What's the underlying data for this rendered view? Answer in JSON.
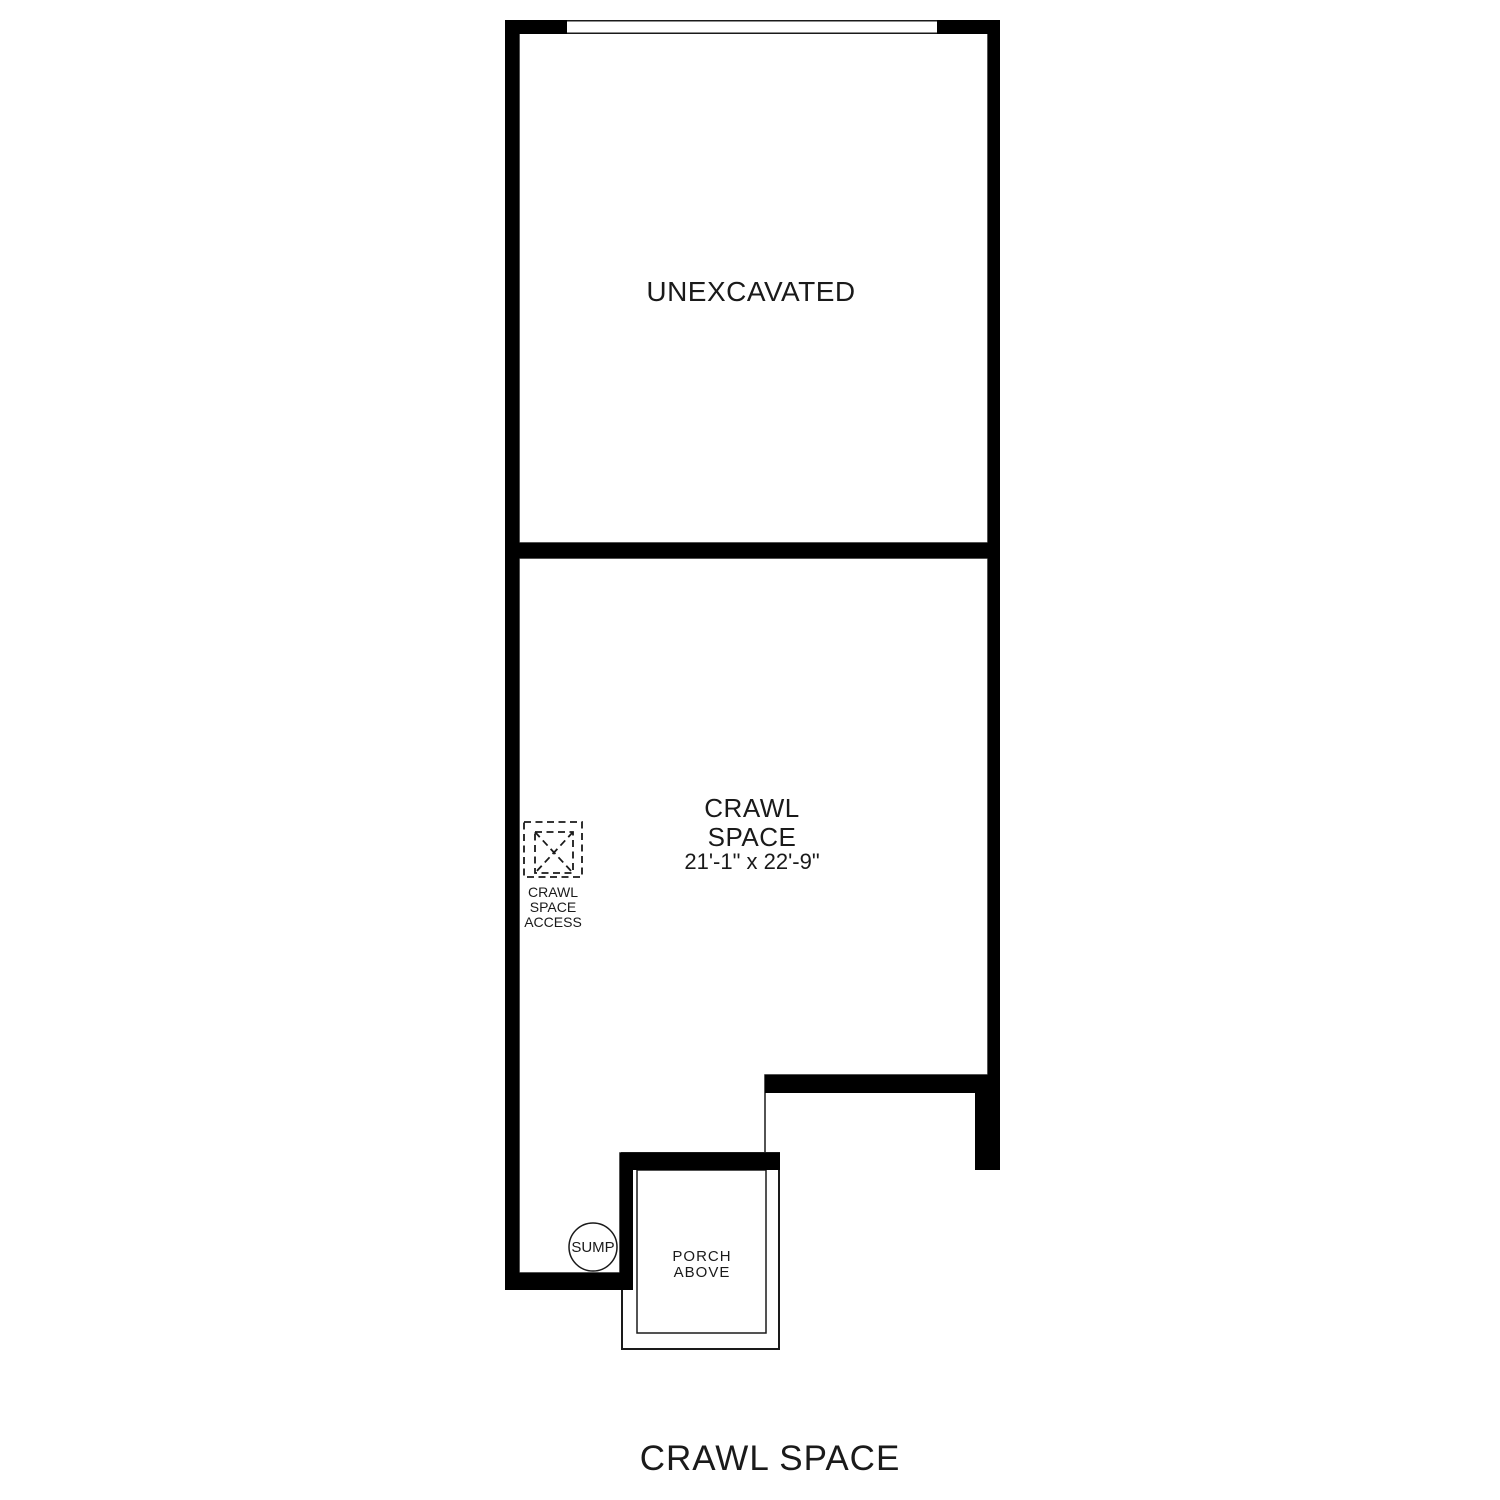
{
  "plan": {
    "title": "CRAWL SPACE",
    "rooms": {
      "unexcavated": {
        "label": "UNEXCAVATED"
      },
      "crawl_space": {
        "label_line1": "CRAWL",
        "label_line2": "SPACE",
        "dimensions": "21'-1\" x 22'-9\""
      },
      "porch": {
        "label_line1": "PORCH",
        "label_line2": "ABOVE"
      }
    },
    "features": {
      "access": {
        "icon": "crawl-space-access-hatch-icon",
        "label_line1": "CRAWL",
        "label_line2": "SPACE",
        "label_line3": "ACCESS"
      },
      "sump": {
        "icon": "sump-pit-circle-icon",
        "label": "SUMP"
      }
    },
    "colors": {
      "wall": "#000000",
      "line": "#1a1a1a",
      "text": "#1a1a1a",
      "background": "#ffffff"
    }
  }
}
